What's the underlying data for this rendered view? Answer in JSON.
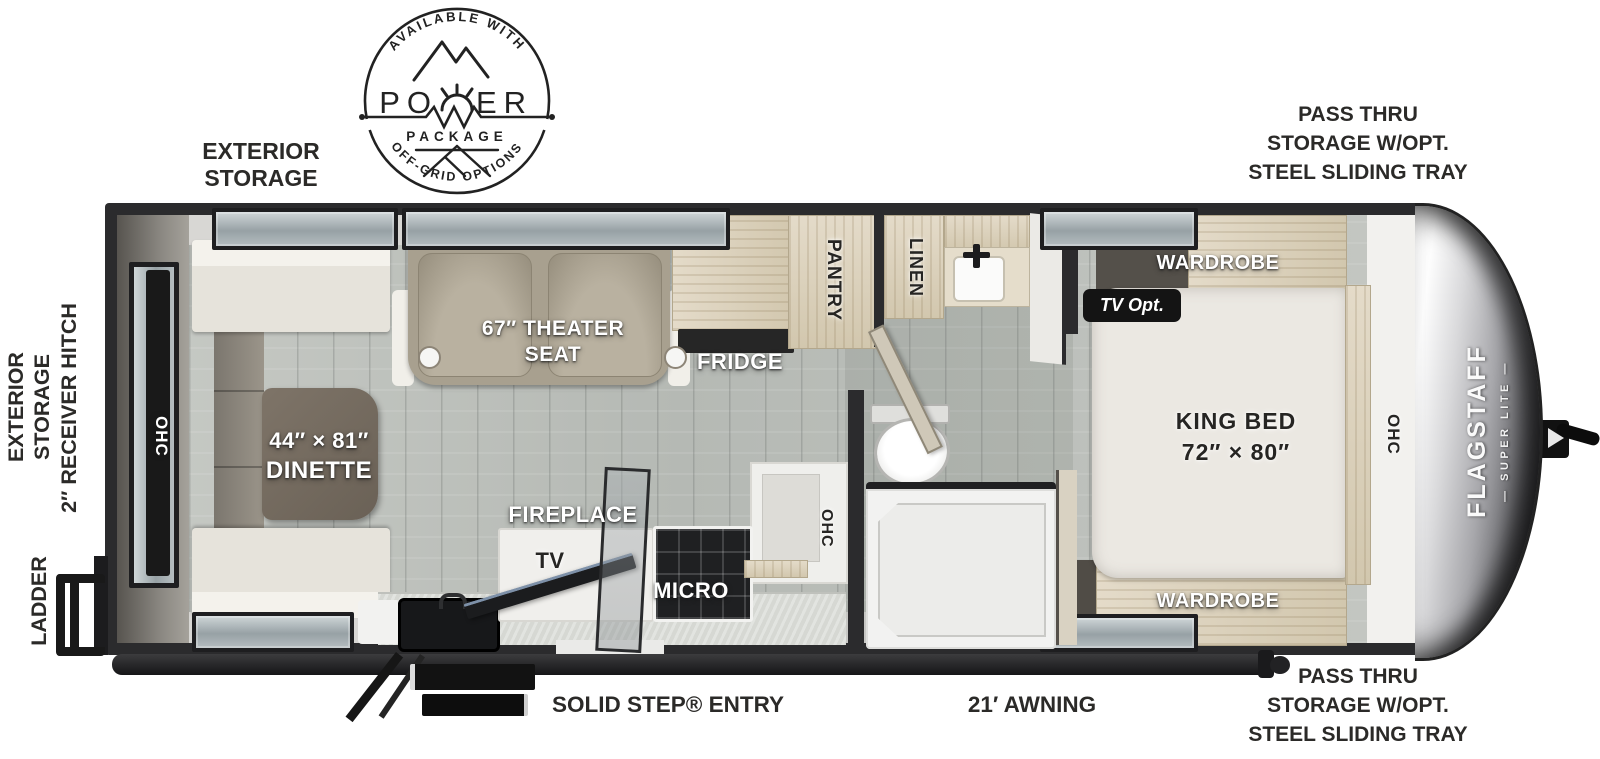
{
  "badge": {
    "available_with": "AVAILABLE WITH",
    "power_left": "PO",
    "power_right": "ER",
    "package": "PACKAGE",
    "off_grid": "OFF-GRID OPTIONS"
  },
  "brand": {
    "name": "FLAGSTAFF",
    "series_display": "— SUPER LITE —"
  },
  "exterior": {
    "storage_top_line1": "EXTERIOR",
    "storage_top_line2": "STORAGE",
    "pass_thru_lines": [
      "PASS THRU",
      "STORAGE W/OPT.",
      "STEEL SLIDING TRAY"
    ],
    "storage_left_line1": "EXTERIOR",
    "storage_left_line2": "STORAGE",
    "receiver_hitch": "2″ RECEIVER HITCH",
    "ladder": "LADDER",
    "entry": "SOLID STEP® ENTRY",
    "awning": "21′ AWNING"
  },
  "interior": {
    "ohc_rear": "OHC",
    "dinette_line1": "44″ × 81″",
    "dinette_line2": "DINETTE",
    "theater_line1": "67″ THEATER",
    "theater_line2": "SEAT",
    "fridge": "FRIDGE",
    "pantry": "PANTRY",
    "linen": "LINEN",
    "fireplace": "FIREPLACE",
    "tv": "TV",
    "micro": "MICRO",
    "ohc_kitchen": "OHC",
    "tv_opt": "TV Opt.",
    "wardrobe_top": "WARDROBE",
    "wardrobe_bottom": "WARDROBE",
    "king_line1": "KING BED",
    "king_line2": "72″ × 80″",
    "ohc_front": "OHC"
  },
  "colors": {
    "wall": "#2b2b2d",
    "wood_cabinet": "#ddd3c0",
    "floor": "#c0c3be",
    "theater_seat": "#a8a08f",
    "dinette_table": "#756b60",
    "badge_ink": "#222222",
    "label_white": "#ffffff",
    "tv_opt_bg": "#141414"
  }
}
